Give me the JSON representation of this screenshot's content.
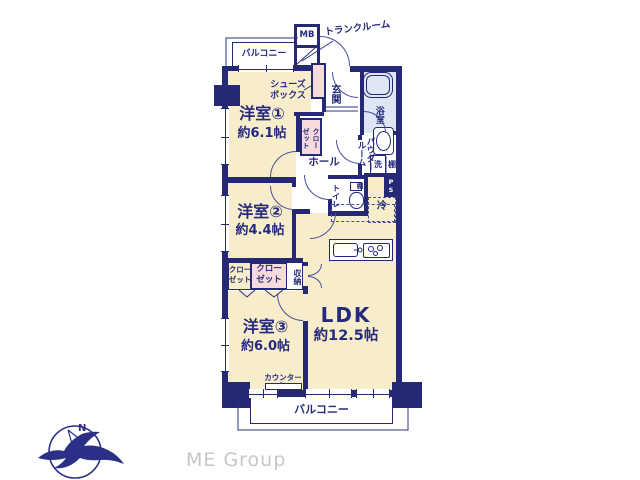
{
  "plan": {
    "balcony_top": "バルコニー",
    "balcony_bottom": "バルコニー",
    "trunk_room": "トランクルーム",
    "meter_box": "MB",
    "entrance": "玄関",
    "shoes_box": "シューズ\nボックス",
    "hall": "ホール",
    "room1": {
      "name": "洋室①",
      "size": "約6.1帖"
    },
    "room2": {
      "name": "洋室②",
      "size": "約4.4帖"
    },
    "room3": {
      "name": "洋室③",
      "size": "約6.0帖"
    },
    "ldk": {
      "name": "LDK",
      "size": "約12.5帖"
    },
    "bathroom": "浴室",
    "powder_room": "パウダー\nルーム",
    "washer": "洗",
    "shelf": "棚",
    "toilet": "トイレ",
    "toilet_shelf": "棚",
    "closet_room1": "クロー\nゼット",
    "closet_left": "クロー\nゼット",
    "closet_mid": "クロー\nゼット",
    "storage": "収納",
    "pipe_space": "P\nS",
    "refrigerator": "冷",
    "counter": "カウンター"
  },
  "branding": {
    "company": "ME Group",
    "compass_north": "N"
  },
  "colors": {
    "wall": "#242875",
    "arc": "#4a4f9b",
    "room_cream": "#f8edcb",
    "closet_pink": "#f7dbdb",
    "wet_blue": "#dde6f2",
    "text_navy": "#252a7d",
    "logo_gray": "#c6c6cb"
  }
}
